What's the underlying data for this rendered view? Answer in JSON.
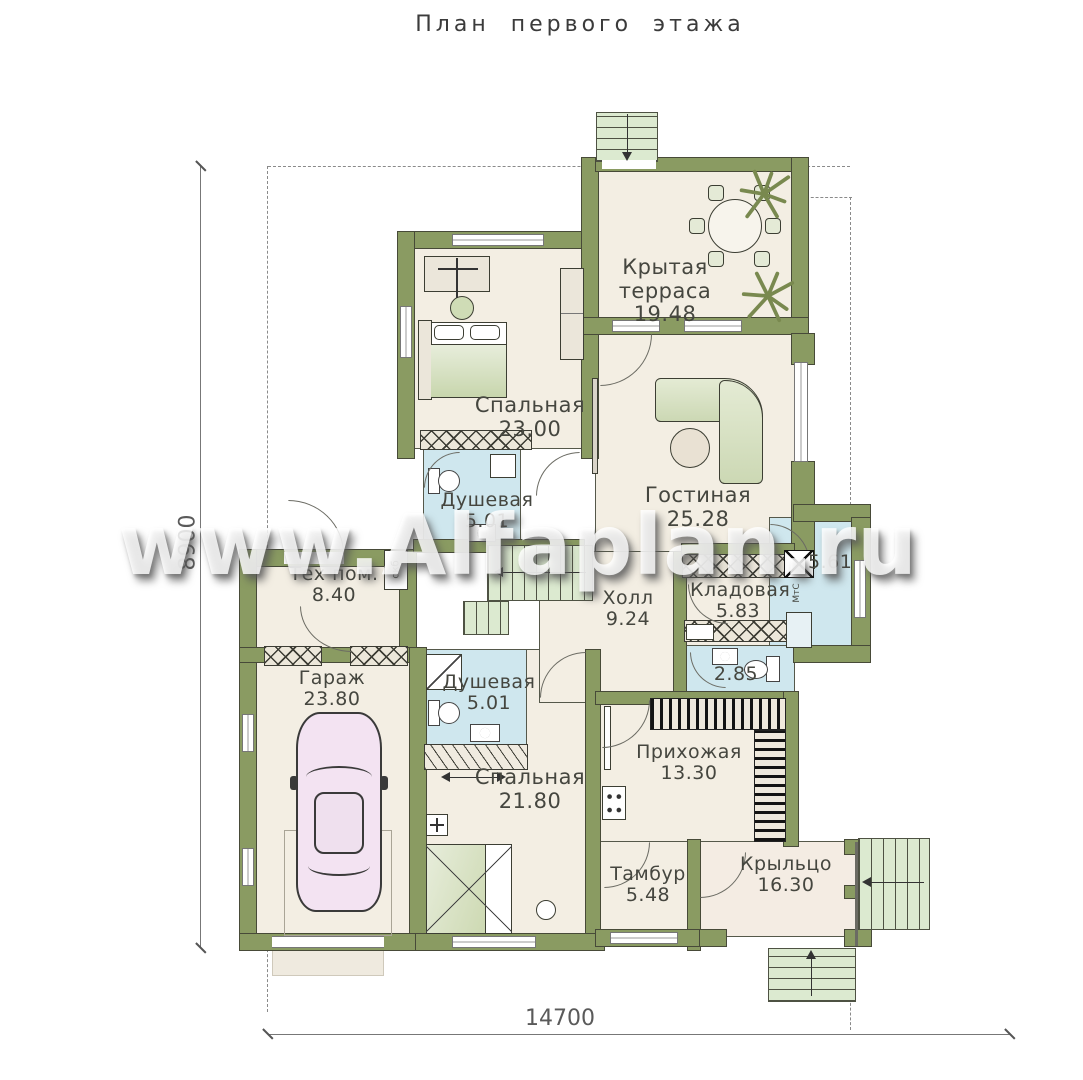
{
  "title": "План первого этажа",
  "watermark": "www.Alfaplan.ru",
  "dimensions": {
    "bottom": "14700",
    "left": "8900"
  },
  "colors": {
    "wall": "#8a9b62",
    "floor": "#f3eee3",
    "wet_room": "#cfe7ee",
    "stairs": "#dcead0",
    "car": "#f3e3f2",
    "label_text": "#45463f",
    "watermark_text": "#ffffff"
  },
  "rooms": {
    "terrace": {
      "name": "Крытая терраса",
      "area": "19.48"
    },
    "bedroom1": {
      "name": "Спальная",
      "area": "23.00"
    },
    "living": {
      "name": "Гостиная",
      "area": "25.28"
    },
    "shower1": {
      "name": "Душевая",
      "area": "5.01"
    },
    "tech": {
      "name": "Тех пом.",
      "area": "8.40"
    },
    "hall": {
      "name": "Холл",
      "area": "9.24"
    },
    "storage": {
      "name": "Кладовая",
      "area": "5.83"
    },
    "laundry": {
      "name": "",
      "area": "5.61"
    },
    "wc": {
      "name": "",
      "area": "2.85"
    },
    "garage": {
      "name": "Гараж",
      "area": "23.80"
    },
    "shower2": {
      "name": "Душевая",
      "area": "5.01"
    },
    "bedroom2": {
      "name": "Спальная",
      "area": "21.80"
    },
    "entry": {
      "name": "Прихожая",
      "area": "13.30"
    },
    "tambour": {
      "name": "Тамбур",
      "area": "5.48"
    },
    "porch": {
      "name": "Крыльцо",
      "area": "16.30"
    }
  },
  "small_labels": {
    "boiler": "окб",
    "washer": "МтС"
  }
}
